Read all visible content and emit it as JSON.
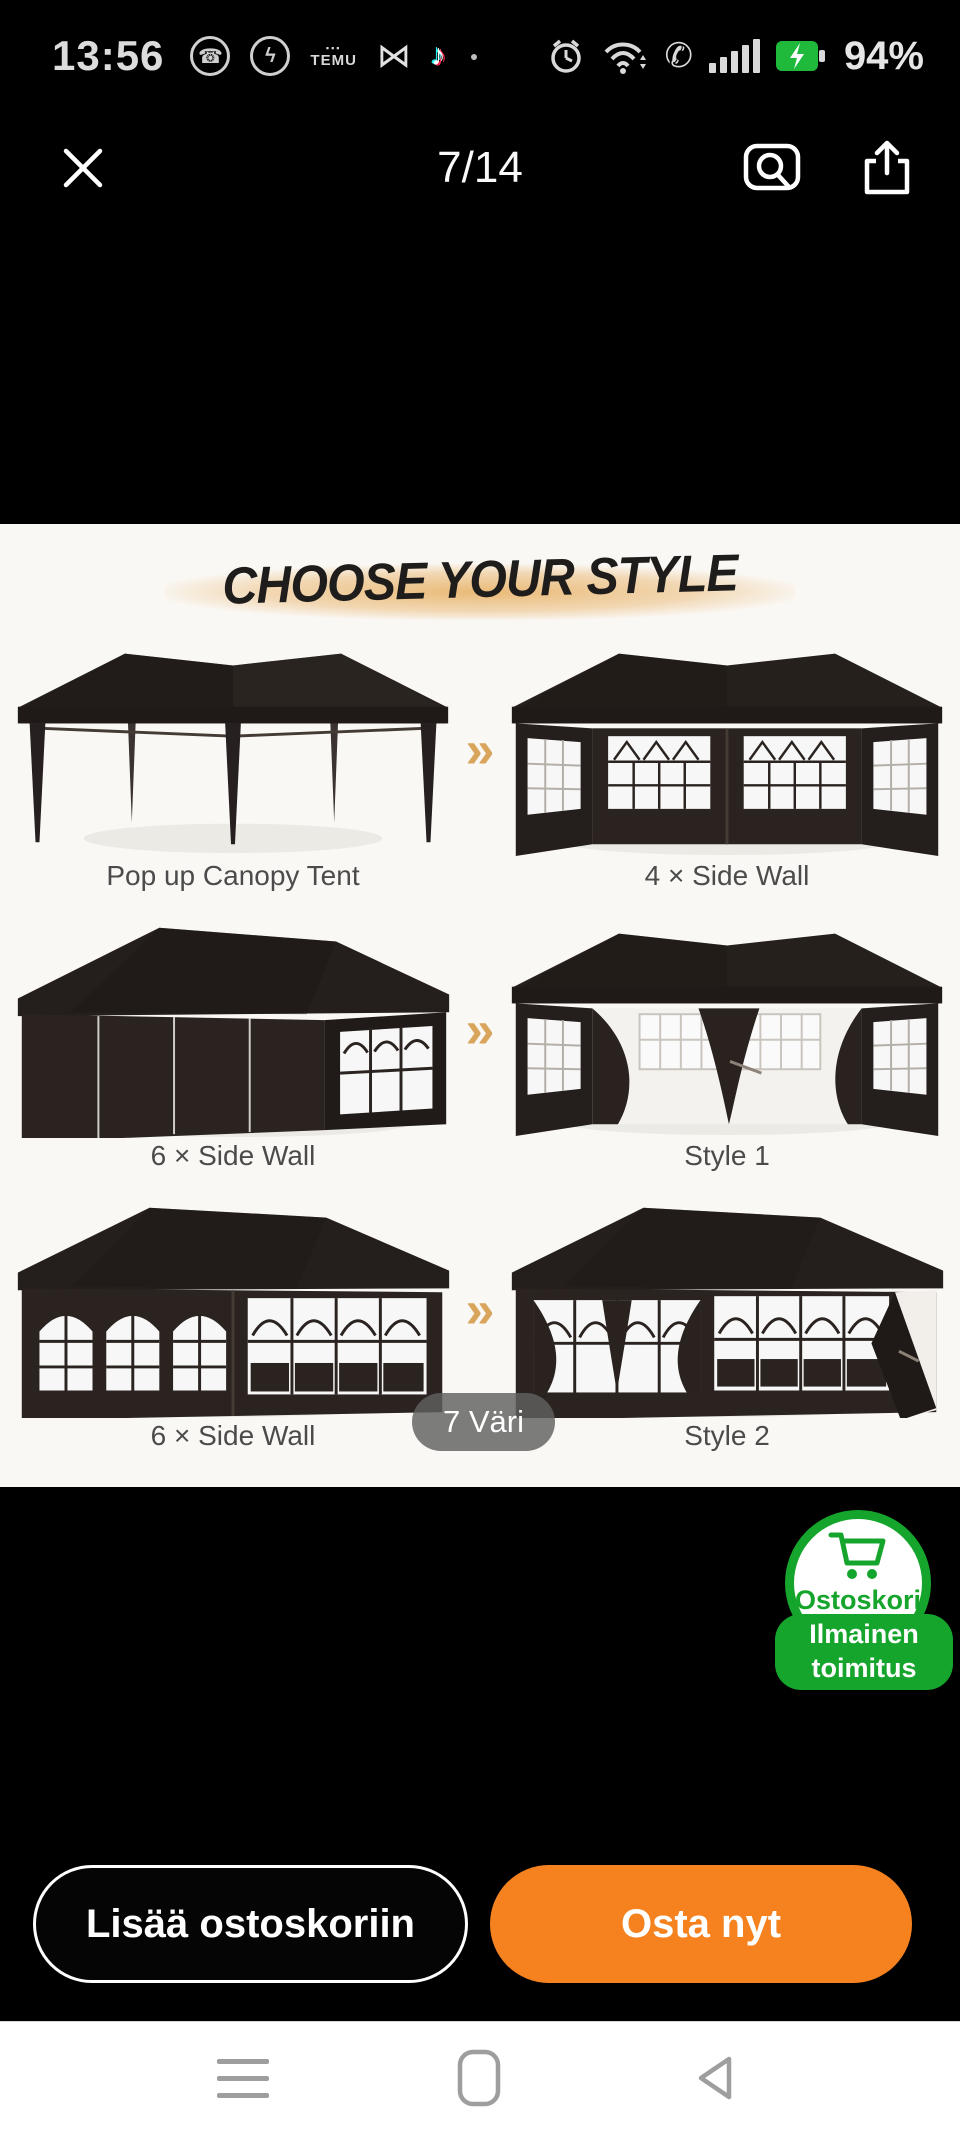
{
  "status_bar": {
    "time": "13:56",
    "battery_percent": "94%",
    "temu_label": "TEMU"
  },
  "gallery_header": {
    "counter": "7/14"
  },
  "product_image": {
    "title": "CHOOSE YOUR STYLE",
    "arrow_glyph": "»",
    "variant_badge": "7 Väri",
    "styles": [
      {
        "label": "Pop up Canopy Tent"
      },
      {
        "label": "4 × Side Wall"
      },
      {
        "label": "6 × Side Wall"
      },
      {
        "label": "Style 1"
      },
      {
        "label": "6 × Side Wall"
      },
      {
        "label": "Style 2"
      }
    ]
  },
  "cart_badge": {
    "title": "Ostoskori",
    "line1": "Ilmainen",
    "line2": "toimitus"
  },
  "actions": {
    "add_to_cart": "Lisää ostoskoriin",
    "buy_now": "Osta nyt"
  },
  "colors": {
    "buy_now_orange": "#f5821f",
    "badge_green": "#16a52c",
    "arrow_tan": "#d9a45b",
    "tent_dark": "#262120",
    "photo_background": "#faf8f5"
  }
}
